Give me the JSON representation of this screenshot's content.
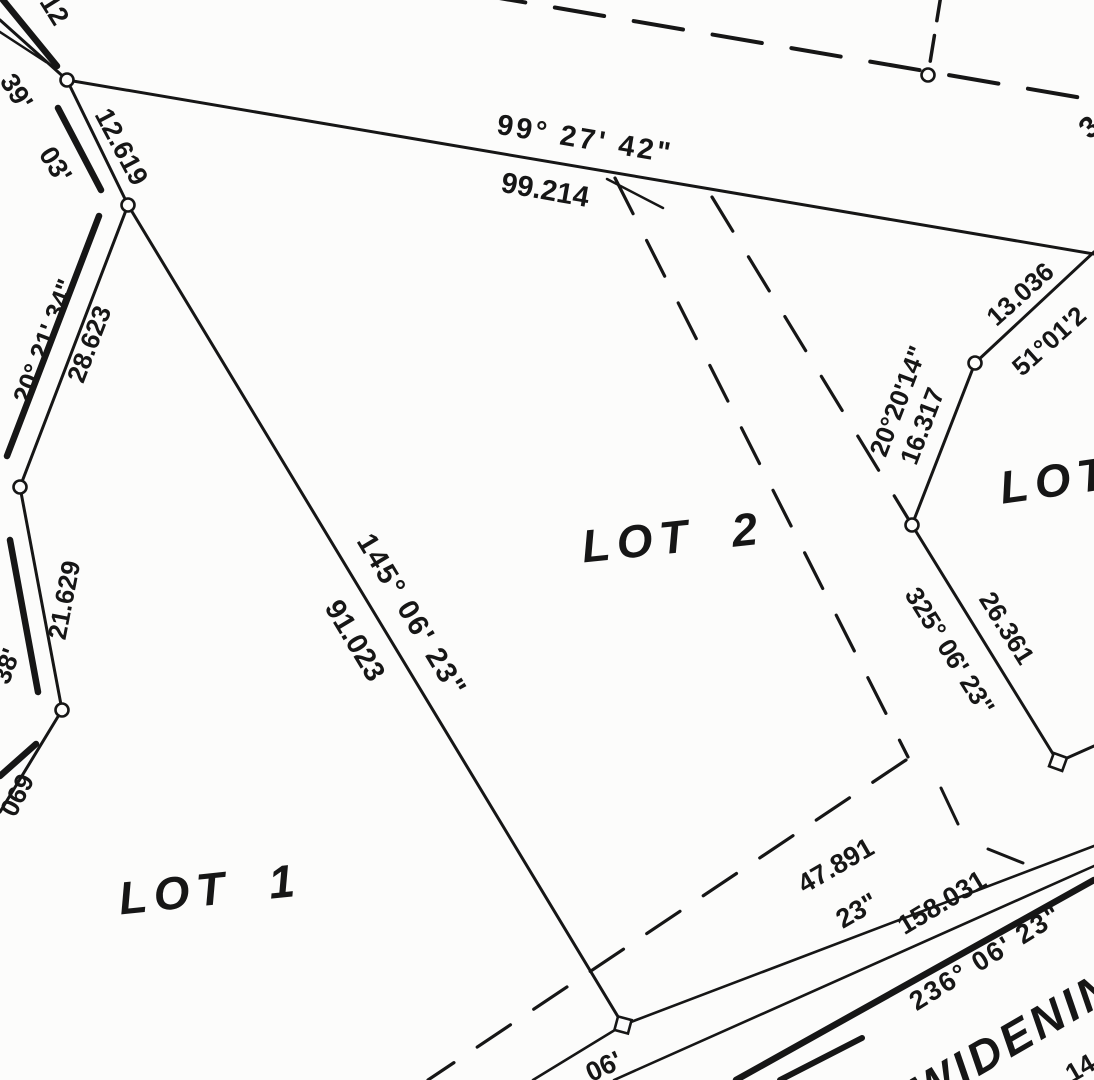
{
  "colors": {
    "ink": "#161616",
    "paper": "#fcfcfb"
  },
  "labels": {
    "frag_top_left": "12",
    "frag_39": "39'",
    "frag_03": "03'",
    "dist_12_619": "12.619",
    "brg_20_21_34": "20° 21' 34\"",
    "dist_28_623": "28.623",
    "dist_21_629": "21.629",
    "frag_38": "38'",
    "frag_069": "069",
    "brg_99_27_42": "99° 27' 42\"",
    "dist_99_214": "99.214",
    "brg_145_06_23": "145° 06' 23\"",
    "dist_91_023": "91.023",
    "lot1": "LOT 1",
    "lot2": "LOT 2",
    "lot3_partial": "LOT",
    "dist_13_036": "13.036",
    "brg_51_01_2_partial": "51°01'2",
    "brg_20_20_14": "20°20'14\"",
    "dist_16_317": "16.317",
    "brg_325_06_23": "325° 06' 23\"",
    "dist_26_361": "26.361",
    "dist_47_891": "47.891",
    "frag_23_sec": "23\"",
    "dist_158_031": "158.031",
    "brg_236_06_23": "236° 06' 23\"",
    "road_widening_partial": "WIDENIN",
    "frag_14": "14",
    "frag_06": "06'",
    "frag_3": "3"
  }
}
